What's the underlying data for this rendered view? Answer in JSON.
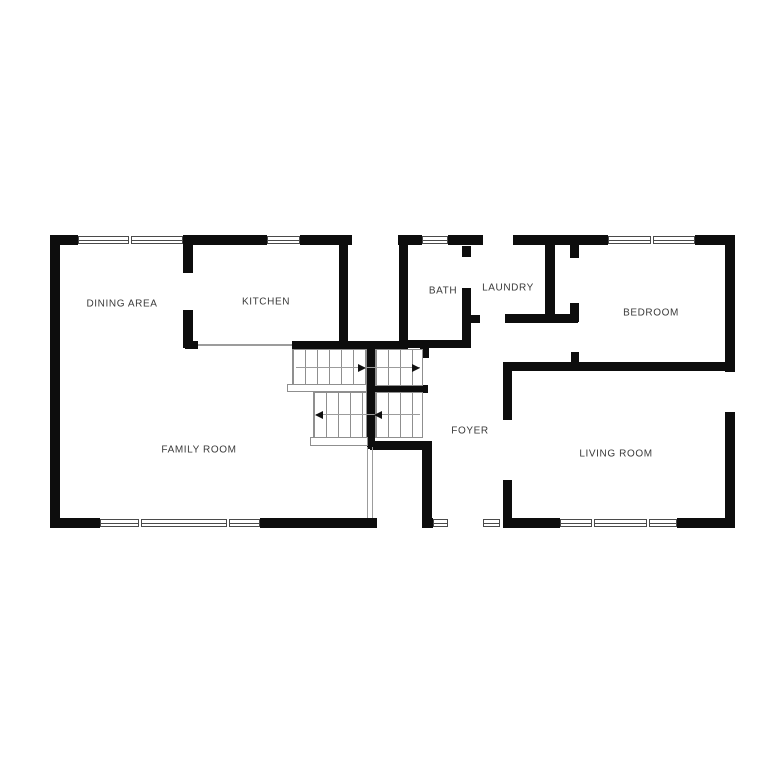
{
  "floor_plan": {
    "colors": {
      "wall": "#0d0d0d",
      "label_text": "#3a3a3a",
      "background": "#ffffff",
      "stair_line": "#8f8f8f"
    },
    "rooms": [
      {
        "id": "dining-area",
        "label": "DINING AREA",
        "x": 122,
        "y": 304
      },
      {
        "id": "kitchen",
        "label": "KITCHEN",
        "x": 266,
        "y": 302
      },
      {
        "id": "bath",
        "label": "BATH",
        "x": 443,
        "y": 291
      },
      {
        "id": "laundry",
        "label": "LAUNDRY",
        "x": 508,
        "y": 288
      },
      {
        "id": "bedroom",
        "label": "BEDROOM",
        "x": 651,
        "y": 313
      },
      {
        "id": "family-room",
        "label": "FAMILY ROOM",
        "x": 199,
        "y": 450
      },
      {
        "id": "foyer",
        "label": "FOYER",
        "x": 470,
        "y": 431
      },
      {
        "id": "living-room",
        "label": "LIVING ROOM",
        "x": 616,
        "y": 454
      }
    ],
    "geometry": {
      "canvas": {
        "width": 768,
        "height": 768
      },
      "walls": [
        [
          50,
          235,
          10,
          293
        ],
        [
          50,
          235,
          28,
          10
        ],
        [
          183,
          235,
          84,
          10
        ],
        [
          300,
          235,
          52,
          10
        ],
        [
          398,
          235,
          24,
          10
        ],
        [
          448,
          235,
          35,
          10
        ],
        [
          513,
          235,
          95,
          10
        ],
        [
          695,
          235,
          40,
          10
        ],
        [
          725,
          235,
          10,
          137
        ],
        [
          725,
          412,
          10,
          116
        ],
        [
          50,
          518,
          50,
          10
        ],
        [
          260,
          518,
          117,
          10
        ],
        [
          422,
          518,
          11,
          10
        ],
        [
          503,
          518,
          57,
          10
        ],
        [
          677,
          518,
          58,
          10
        ],
        [
          183,
          235,
          10,
          38
        ],
        [
          183,
          310,
          10,
          38
        ],
        [
          339,
          238,
          9,
          110
        ],
        [
          185,
          341,
          13,
          8
        ],
        [
          292,
          341,
          116,
          8
        ],
        [
          399,
          238,
          9,
          110
        ],
        [
          399,
          340,
          71,
          8
        ],
        [
          462,
          246,
          9,
          11
        ],
        [
          462,
          288,
          9,
          60
        ],
        [
          462,
          315,
          18,
          8
        ],
        [
          545,
          242,
          10,
          75
        ],
        [
          505,
          314,
          73,
          9
        ],
        [
          570,
          242,
          9,
          16
        ],
        [
          570,
          303,
          9,
          19
        ],
        [
          571,
          352,
          8,
          12
        ],
        [
          503,
          362,
          227,
          9
        ],
        [
          367,
          341,
          8,
          108
        ],
        [
          375,
          385,
          53,
          8
        ],
        [
          420,
          348,
          9,
          10
        ],
        [
          370,
          441,
          62,
          9
        ],
        [
          422,
          441,
          10,
          87
        ],
        [
          503,
          363,
          9,
          57
        ],
        [
          503,
          480,
          9,
          48
        ]
      ],
      "windows": [
        {
          "x": 78,
          "y": 236,
          "w": 105,
          "h": 8,
          "dividers": [
            49
          ]
        },
        {
          "x": 267,
          "y": 236,
          "w": 33,
          "h": 8,
          "dividers": []
        },
        {
          "x": 422,
          "y": 236,
          "w": 26,
          "h": 8,
          "dividers": []
        },
        {
          "x": 608,
          "y": 236,
          "w": 87,
          "h": 8,
          "dividers": [
            41
          ]
        },
        {
          "x": 100,
          "y": 519,
          "w": 160,
          "h": 8,
          "dividers": [
            37,
            125
          ]
        },
        {
          "x": 433,
          "y": 519,
          "w": 15,
          "h": 8,
          "dividers": []
        },
        {
          "x": 483,
          "y": 519,
          "w": 17,
          "h": 8,
          "dividers": []
        },
        {
          "x": 560,
          "y": 519,
          "w": 117,
          "h": 8,
          "dividers": [
            30,
            85
          ]
        }
      ],
      "stair_treads": [
        {
          "x": 292,
          "y": 349,
          "w": 75,
          "h": 37
        },
        {
          "x": 375,
          "y": 349,
          "w": 48,
          "h": 37
        },
        {
          "x": 313,
          "y": 392,
          "w": 54,
          "h": 46
        },
        {
          "x": 375,
          "y": 392,
          "w": 48,
          "h": 46
        }
      ],
      "landings": [
        {
          "x": 287,
          "y": 384,
          "w": 80,
          "h": 8
        },
        {
          "x": 310,
          "y": 437,
          "w": 58,
          "h": 9
        }
      ],
      "guide_lines": [
        {
          "x": 296,
          "y": 367,
          "w": 124,
          "h": 1
        },
        {
          "x": 316,
          "y": 414,
          "w": 104,
          "h": 1
        },
        {
          "x": 198,
          "y": 344,
          "w": 94,
          "h": 2
        },
        {
          "x": 367,
          "y": 447,
          "w": 1,
          "h": 71
        },
        {
          "x": 372,
          "y": 447,
          "w": 1,
          "h": 71
        }
      ],
      "stair_arrows": [
        {
          "x": 358,
          "y": 368,
          "dir": "right"
        },
        {
          "x": 412,
          "y": 368,
          "dir": "right"
        },
        {
          "x": 315,
          "y": 415,
          "dir": "left"
        },
        {
          "x": 374,
          "y": 415,
          "dir": "left"
        }
      ]
    }
  }
}
